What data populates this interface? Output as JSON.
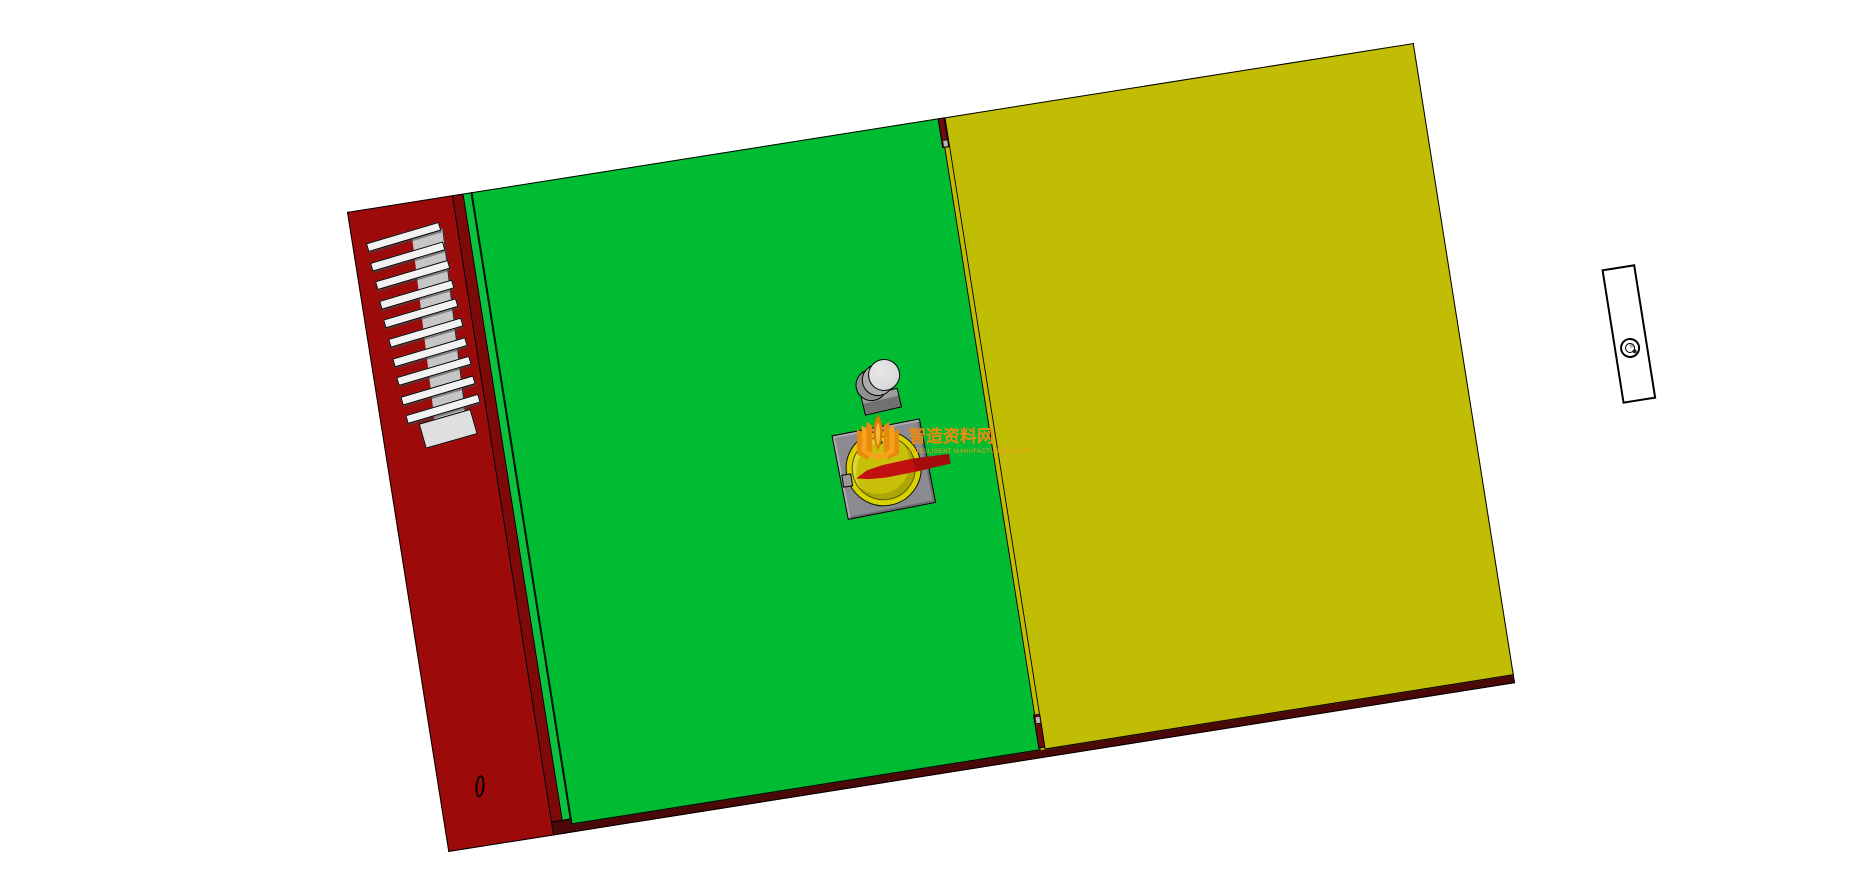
{
  "scene": {
    "type": "3d-cad-render",
    "description": "3D CAD model preview of a two-door electrical control cabinet on a white background",
    "background_color": "#FFFFFF"
  },
  "colors": {
    "side_panel": "#9C0A0A",
    "side_band": "#7E0909",
    "frame_edge": "#0AC23E",
    "door_left": "#00BC32",
    "door_right": "#C1BD05",
    "plinth": "#4A0808",
    "gap_interior": "#6E0C0C",
    "louver_slat": "#F2F2F2",
    "louver_duct": "#C6C6C6",
    "switch_plate": "#8A8A90",
    "switch_ring": "#D9D100",
    "switch_face": "#C9C00A",
    "switch_handle": "#C21010",
    "button_head": "#DCDCDC",
    "button_base": "#717171",
    "watermark": "#ED8A0F"
  },
  "cabinet": {
    "rotation_deg": -9,
    "parts": {
      "side_panel": "red left side panel",
      "louver_vent": {
        "label": "ventilation louver",
        "slat_count": 10
      },
      "cable_hole": "small oval knockout near bottom of side panel",
      "left_door": "green front door with push button and rotary main switch",
      "right_door": "yellow front door with recessed lock plate",
      "push_button": "gray mushroom push button",
      "rotary_switch": "yellow rotary disconnect switch with red handle",
      "door_lock": "cam lock cylinder",
      "plinth": "dark maroon bottom rail"
    }
  },
  "watermark": {
    "title": "智造资料网",
    "subtitle": "INTELLIGENT MANUFACTURING DATA"
  }
}
